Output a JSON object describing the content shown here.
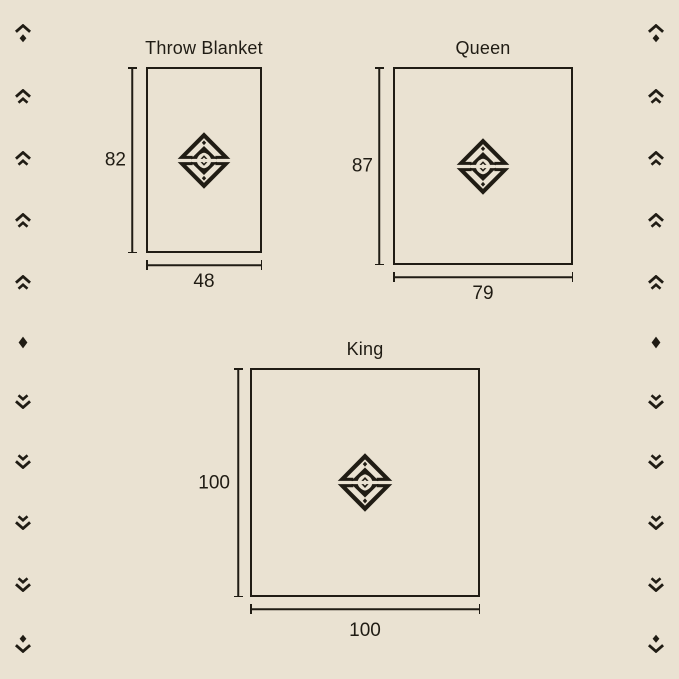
{
  "page": {
    "colors": {
      "background": "#eae2d2",
      "ink": "#201c14"
    }
  },
  "diagrams": [
    {
      "id": "throw",
      "label": "Throw Blanket",
      "height": "82",
      "width": "48"
    },
    {
      "id": "queen",
      "label": "Queen",
      "height": "87",
      "width": "79"
    },
    {
      "id": "king",
      "label": "King",
      "height": "100",
      "width": "100"
    }
  ],
  "logo": {
    "name": "brand-diamond-emblem"
  },
  "side_rail": {
    "columns": [
      "left",
      "right"
    ],
    "sequence": [
      "chevron-up-diamond",
      "double-chevron-up",
      "double-chevron-up",
      "double-chevron-up",
      "double-chevron-up",
      "diamond",
      "double-chevron-down",
      "double-chevron-down",
      "double-chevron-down",
      "double-chevron-down",
      "diamond-chevron-down"
    ]
  }
}
